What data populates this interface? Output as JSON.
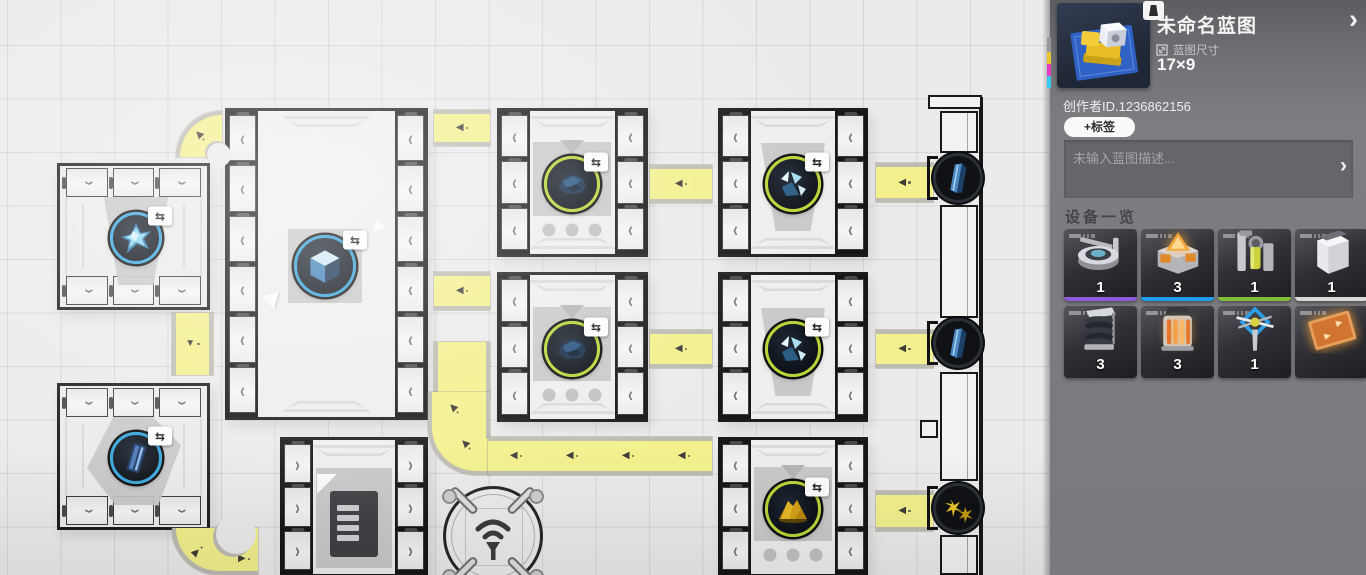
{
  "panel": {
    "title": "未命名蓝图",
    "chevron": "›",
    "size_label": "蓝图尺寸",
    "size_value": "17×9",
    "creator_id": "创作者ID.1236862156",
    "tag_button": "+标签",
    "description_placeholder": "未输入蓝图描述...",
    "equipment_title": "设备一览",
    "accent_colors": {
      "purple": "#8f5bdb",
      "blue": "#1f9ceb",
      "green": "#82bd38",
      "white": "#d9d9d9"
    },
    "equipment": [
      {
        "icon": "assembler-machine",
        "count": "1",
        "bar": "#8f5bdb"
      },
      {
        "icon": "smelter-orange-triangle",
        "count": "3",
        "bar": "#1f9ceb"
      },
      {
        "icon": "extractor-column",
        "count": "1",
        "bar": "#82bd38"
      },
      {
        "icon": "storage-cabinet",
        "count": "1",
        "bar": "#d9d9d9"
      },
      {
        "icon": "coil-tower",
        "count": "3",
        "bar": ""
      },
      {
        "icon": "heat-furnace",
        "count": "3",
        "bar": ""
      },
      {
        "icon": "signal-frame",
        "count": "1",
        "bar": ""
      },
      {
        "icon": "conveyor-panel",
        "count": "",
        "bar": ""
      }
    ]
  },
  "glyphs": {
    "belt_left": "◀",
    "belt_right": "▶",
    "belt_down": "▼",
    "door_left": "‹",
    "door_right": "›",
    "swap": "⇆"
  }
}
